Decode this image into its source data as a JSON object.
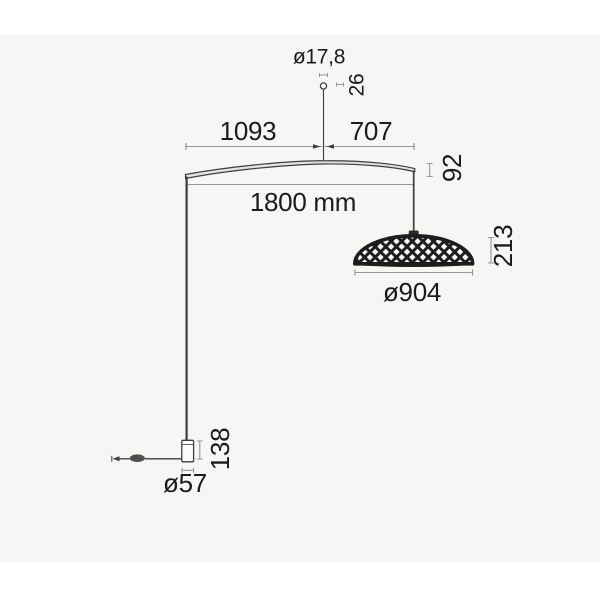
{
  "title": "Floor lamp dimension drawing",
  "labels": {
    "stem_diameter": "ø17,8",
    "stem_height": "26",
    "span_left": "1093",
    "span_right": "707",
    "span_total": "1800 mm",
    "arm_end_height": "92",
    "shade_height": "213",
    "shade_diameter": "ø904",
    "base_height": "138",
    "base_diameter": "ø57"
  },
  "colors": {
    "page": "#ffffff",
    "canvas": "#f6f6f4",
    "ink": "#1b1b1b",
    "line": "#3d3d3d",
    "dim": "#969696",
    "shade": "#1d1d1d",
    "blade-fill": "#e3e3e0",
    "base-fill": "#fcfcfb",
    "switch": "#4f4f4f"
  }
}
